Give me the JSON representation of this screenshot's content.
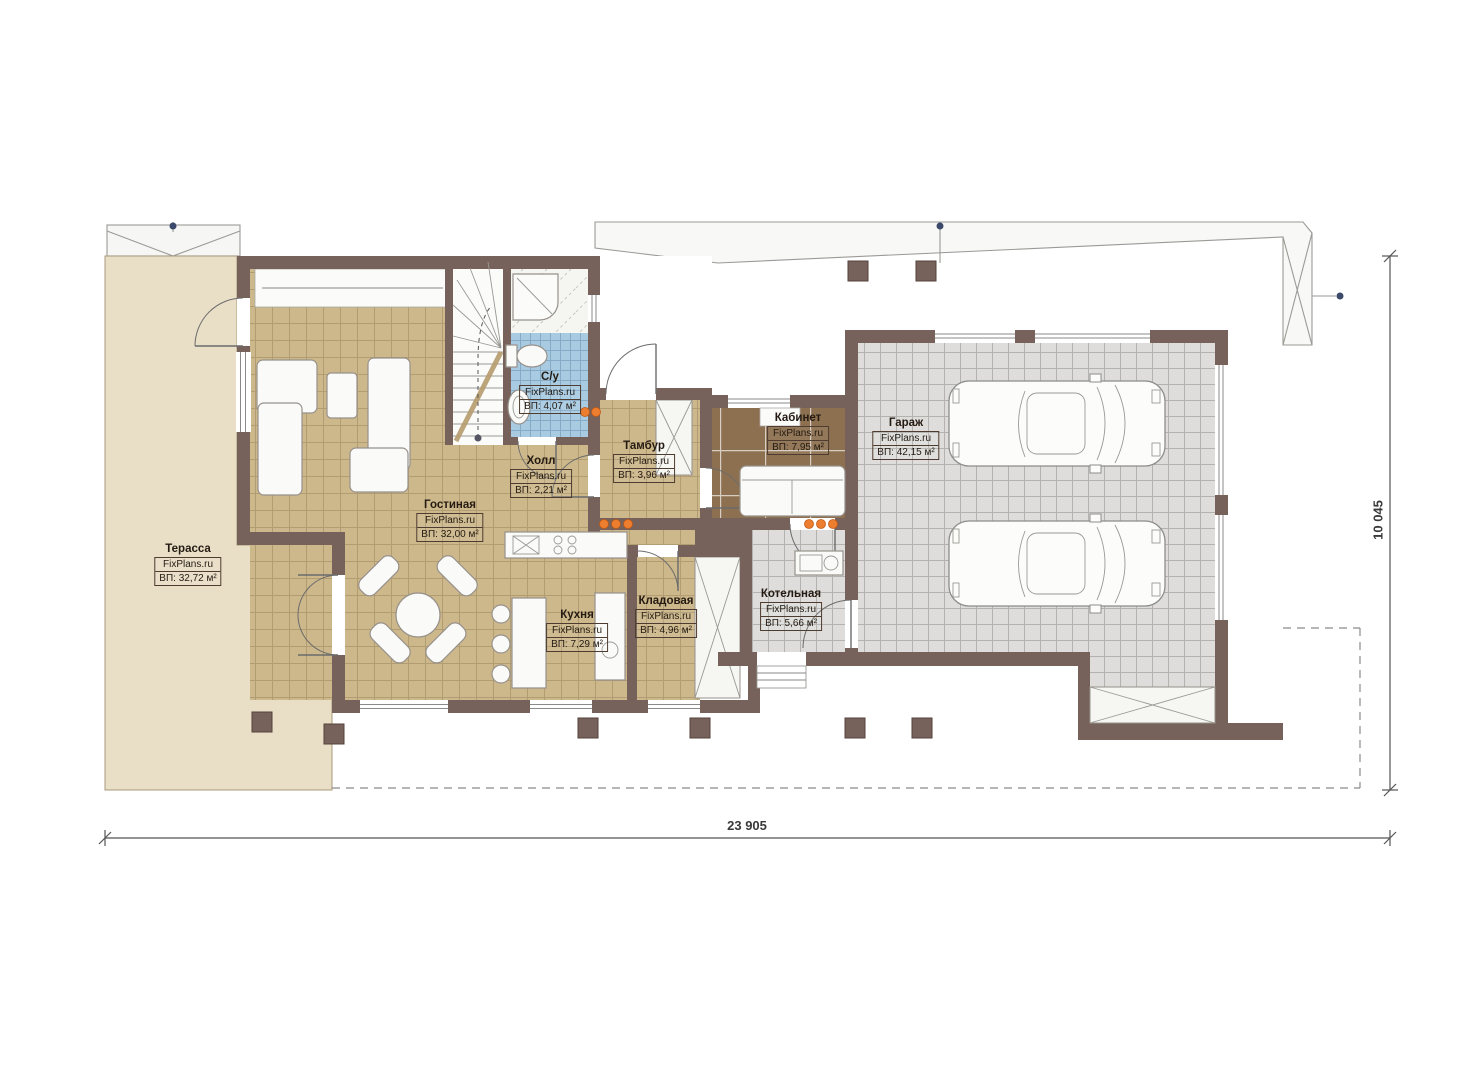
{
  "watermark": "FixPlans.ru",
  "rooms": [
    {
      "name": "Терасса",
      "watermark": "FixPlans.ru",
      "area": "ВП: 32,72 м²"
    },
    {
      "name": "Гостиная",
      "watermark": "FixPlans.ru",
      "area": "ВП: 32,00 м²"
    },
    {
      "name": "Холл",
      "watermark": "FixPlans.ru",
      "area": "ВП: 2,21 м²"
    },
    {
      "name": "С/у",
      "watermark": "FixPlans.ru",
      "area": "ВП: 4,07 м²"
    },
    {
      "name": "Тамбур",
      "watermark": "FixPlans.ru",
      "area": "ВП: 3,96 м²"
    },
    {
      "name": "Кабинет",
      "watermark": "FixPlans.ru",
      "area": "ВП: 7,95 м²"
    },
    {
      "name": "Гараж",
      "watermark": "FixPlans.ru",
      "area": "ВП: 42,15 м²"
    },
    {
      "name": "Кухня",
      "watermark": "FixPlans.ru",
      "area": "ВП: 7,29 м²"
    },
    {
      "name": "Кладовая",
      "watermark": "FixPlans.ru",
      "area": "ВП: 4,96 м²"
    },
    {
      "name": "Котельная",
      "watermark": "FixPlans.ru",
      "area": "ВП: 5,66 м²"
    }
  ],
  "dimensions": {
    "bottom": "23 905",
    "right": "10 045"
  },
  "colors": {
    "wall": "#76625a",
    "terrace_floor": "#e9dfc7",
    "tile_tan": "#cdb88c",
    "wood_dark": "#8d7050",
    "tile_gray": "#dedddb",
    "tile_blue": "#a9cbe2",
    "light_orange": "#ed7d2f"
  }
}
